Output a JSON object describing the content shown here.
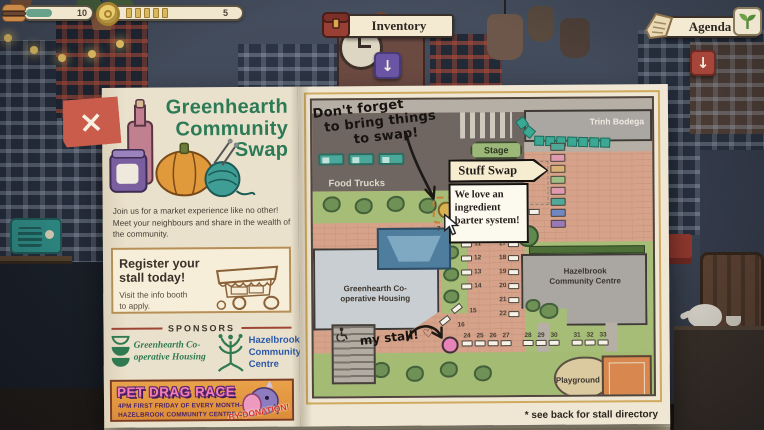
{
  "hud": {
    "energy": {
      "value": "10"
    },
    "coins": {
      "value": "5",
      "ticks": 5
    },
    "inventory": {
      "label": "Inventory",
      "shortcut": "↓"
    },
    "agenda": {
      "label": "Agenda",
      "shortcut": "↓"
    }
  },
  "booklet": {
    "close_label": "×",
    "left_page": {
      "title_lines": [
        "Greenhearth",
        "Community",
        "Swap"
      ],
      "intro": "Join us for a market experience like no other! Meet your neighbours and share in the wealth of the community.",
      "register": {
        "heading": "Register your stall today!",
        "body": "Visit the info booth to apply."
      },
      "sponsors": {
        "heading": "SPONSORS",
        "sponsor1": "Greenhearth Co-operative Housing",
        "sponsor2": "Hazelbrook Community Centre"
      },
      "pet_race": {
        "title": "PET DRAG RACE",
        "line1": "4PM FIRST FRIDAY OF EVERY MONTH—",
        "line2": "HAZELBROOK COMMUNITY CENTRE CAFE",
        "badge": "BY DONATION!"
      }
    },
    "right_page": {
      "note_lines": [
        "Don't forget",
        "to bring things",
        "to swap!"
      ],
      "tooltip": {
        "title": "Stuff Swap",
        "body": "We love an ingredient barter system!"
      },
      "map": {
        "food_trucks_label": "Food Trucks",
        "stage_label": "Stage",
        "trinh_bodega_label": "Trinh Bodega",
        "greenhearth_label": "Greenhearth Co-operative Housing",
        "hazelbrook_label": "Hazelbrook Community Centre",
        "playground_label": "Playground",
        "my_stall_note": "my stall! ♡",
        "hover_stall_number": "7",
        "adjacent_stall_number": "8",
        "left_column_stalls": [
          "11",
          "12",
          "13",
          "14"
        ],
        "right_column_stalls": [
          "17",
          "18",
          "19",
          "20",
          "21",
          "22"
        ],
        "diagonal_stalls": [
          "15",
          "16"
        ],
        "bottom_groups": [
          [
            "24",
            "25",
            "26",
            "27"
          ],
          [
            "28",
            "29",
            "30"
          ],
          [
            "31",
            "32",
            "33"
          ]
        ],
        "colored_stall_colors": [
          "#4fa898",
          "#e09ab0",
          "#d8b074",
          "#9cc084",
          "#e09ab0",
          "#4fa898",
          "#7088c0",
          "#9a78b8"
        ]
      },
      "footnote": "* see back for stall directory"
    }
  },
  "colors": {
    "title_green": "#2d7a56",
    "sponsor_blue": "#2c58a8",
    "banner_pink": "#f480b4",
    "close_red": "#c95c4a",
    "accent_gold": "#d9b85c"
  }
}
